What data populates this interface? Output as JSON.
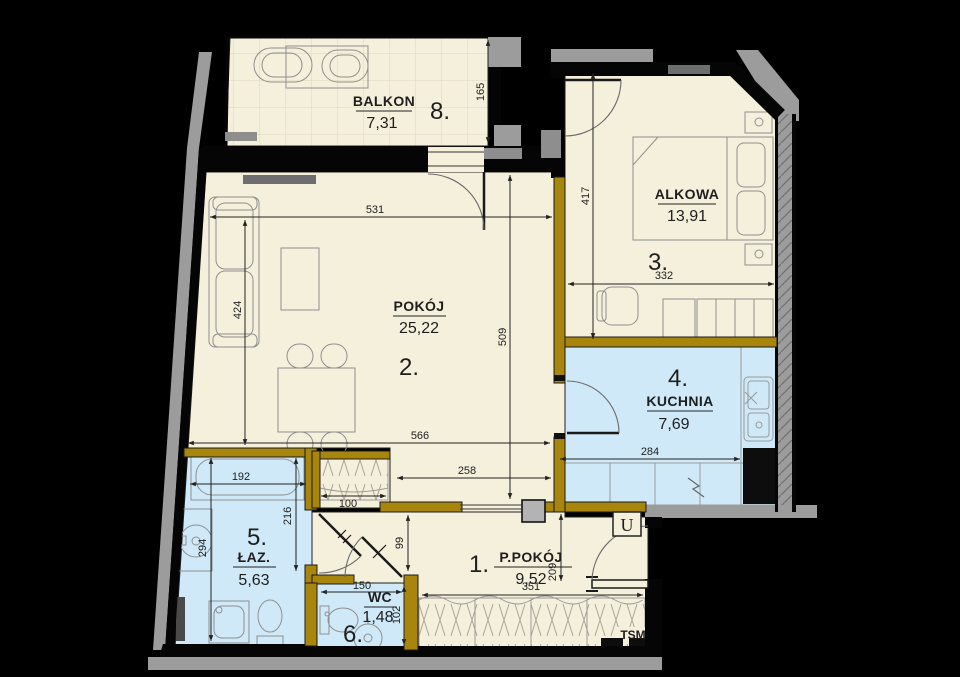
{
  "rooms": [
    {
      "number": "1.",
      "name": "P.POKÓJ",
      "area": "9,52"
    },
    {
      "number": "2.",
      "name": "POKÓJ",
      "area": "25,22"
    },
    {
      "number": "3.",
      "name": "ALKOWA",
      "area": "13,91"
    },
    {
      "number": "4.",
      "name": "KUCHNIA",
      "area": "7,69"
    },
    {
      "number": "5.",
      "name": "ŁAZ.",
      "area": "5,63"
    },
    {
      "number": "6.",
      "name": "WC",
      "area": "1,48"
    },
    {
      "number": "8.",
      "name": "BALKON",
      "area": "7,31"
    }
  ],
  "dimensions": [
    {
      "value": "531"
    },
    {
      "value": "424"
    },
    {
      "value": "509"
    },
    {
      "value": "566"
    },
    {
      "value": "165"
    },
    {
      "value": "417"
    },
    {
      "value": "332"
    },
    {
      "value": "284"
    },
    {
      "value": "258"
    },
    {
      "value": "192"
    },
    {
      "value": "294"
    },
    {
      "value": "216"
    },
    {
      "value": "100"
    },
    {
      "value": "99"
    },
    {
      "value": "150"
    },
    {
      "value": "102"
    },
    {
      "value": "209"
    },
    {
      "value": "351"
    }
  ],
  "labels": {
    "entrance": "U",
    "tsm": "TSM"
  },
  "colors": {
    "background": "#000000",
    "floor_dry": "#f5f0dc",
    "floor_wet": "#cfe9f8",
    "wall_interior": "#a8860d",
    "wall_exterior": "#9c9c9c",
    "wall_structural": "#050505"
  }
}
